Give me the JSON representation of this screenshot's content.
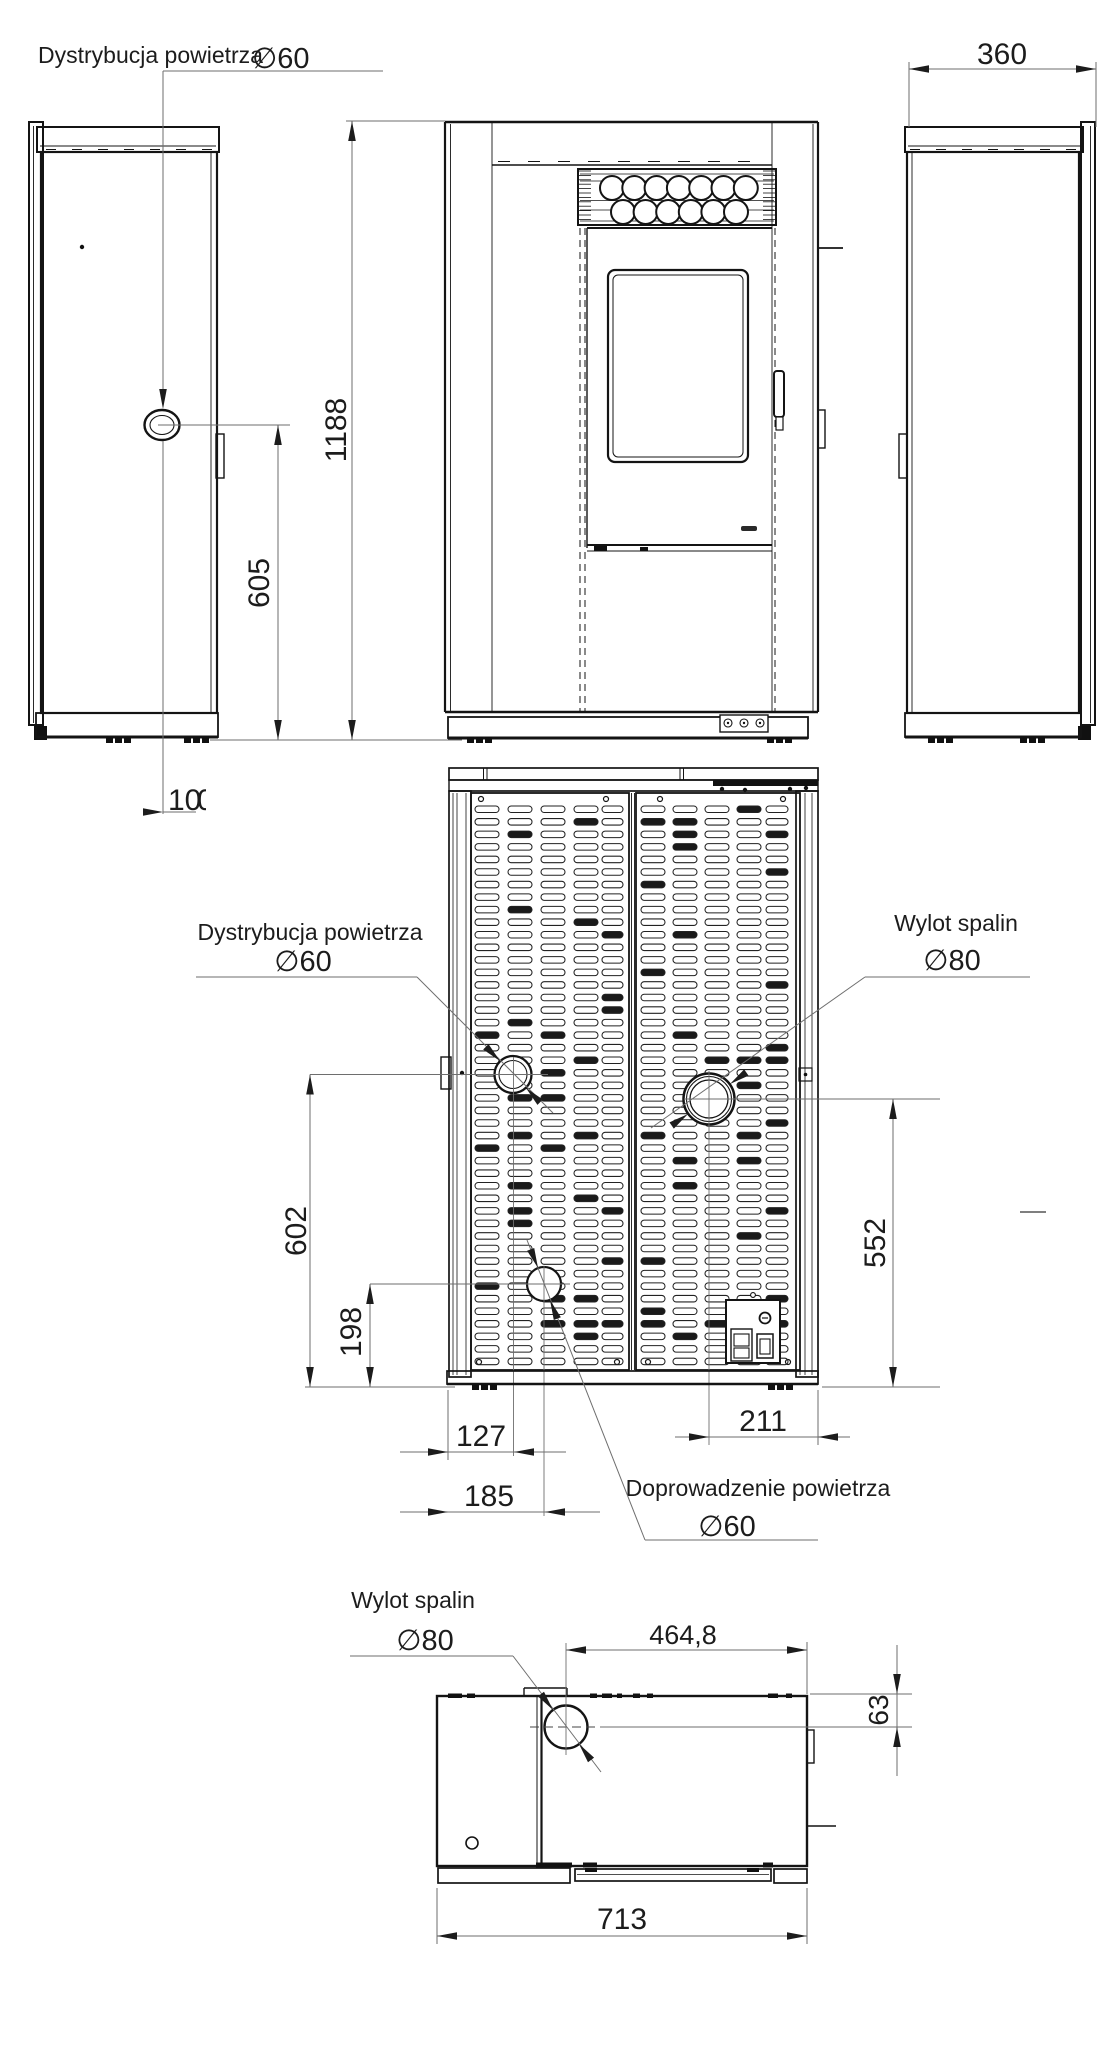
{
  "labels": {
    "air_distribution": "Dystrybucja powietrza",
    "air_distribution_dia": "∅60",
    "flue": "Wylot spalin",
    "flue_dia": "∅80",
    "air_supply": "Doprowadzenie powietrza",
    "air_supply_dia": "∅60"
  },
  "dims": {
    "overall_height": "1188",
    "air_outlet_height": "605",
    "air_outlet_offset": "10",
    "air_outlet_offset_partial": "0",
    "depth": "360",
    "rear_air_outlet_height": "602",
    "air_inlet_height": "198",
    "flue_height": "552",
    "air_outlet_x": "127",
    "air_inlet_x": "185",
    "flue_x": "211",
    "top_flue_x": "464,8",
    "top_flue_y": "63",
    "width": "713"
  }
}
